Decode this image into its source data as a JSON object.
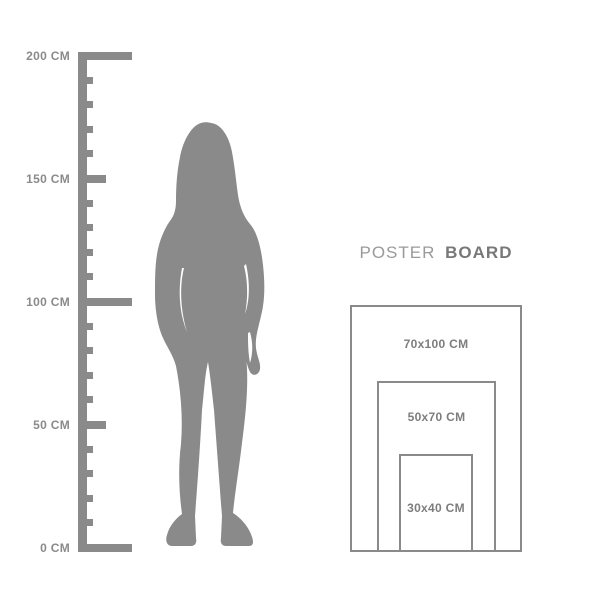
{
  "colors": {
    "figure_gray": "#8a8a8a",
    "ruler_gray": "#8a8a8a",
    "size_label_gray": "#7d7d7d",
    "title_regular_gray": "#9a9a9a",
    "title_bold_gray": "#787878",
    "background": "#ffffff"
  },
  "ruler": {
    "unit": "CM",
    "min_cm": 0,
    "max_cm": 200,
    "major_step_cm": 50,
    "minor_step_cm": 10,
    "labels": [
      {
        "value": 200,
        "text": "200 CM"
      },
      {
        "value": 150,
        "text": "150 CM"
      },
      {
        "value": 100,
        "text": "100 CM"
      },
      {
        "value": 50,
        "text": "50 CM"
      },
      {
        "value": 0,
        "text": "0 CM"
      }
    ]
  },
  "figure": {
    "icon": "standing-woman-silhouette"
  },
  "poster_board": {
    "title": {
      "regular": "POSTER",
      "bold": "BOARD"
    },
    "sizes": [
      {
        "label": "70x100 CM"
      },
      {
        "label": "50x70 CM"
      },
      {
        "label": "30x40 CM"
      }
    ]
  }
}
